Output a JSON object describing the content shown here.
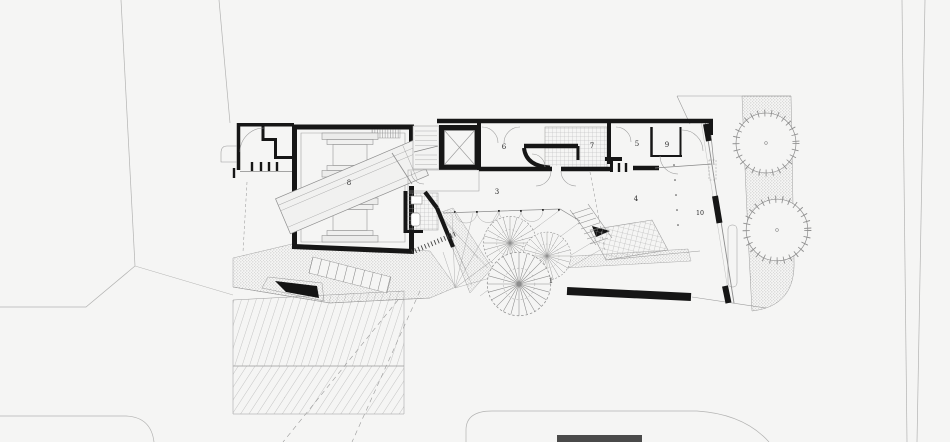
{
  "plan": {
    "kind": "architectural-site-plan",
    "labels": [
      {
        "name": "space-1-garden",
        "text": "1"
      },
      {
        "name": "space-2-ramp",
        "text": "2"
      },
      {
        "name": "space-3-open-room",
        "text": "3"
      },
      {
        "name": "space-4-open-room",
        "text": "4"
      },
      {
        "name": "space-5-room",
        "text": "5"
      },
      {
        "name": "space-6-room",
        "text": "6"
      },
      {
        "name": "space-7-tiled-room",
        "text": "7"
      },
      {
        "name": "space-8-hall",
        "text": "8"
      },
      {
        "name": "space-9-room",
        "text": "9"
      },
      {
        "name": "space-10-sidewalk",
        "text": "10"
      }
    ],
    "colors": {
      "background": "#f5f5f4",
      "wall_ink": "#161616",
      "line_gray": "#9a9a9a"
    }
  }
}
